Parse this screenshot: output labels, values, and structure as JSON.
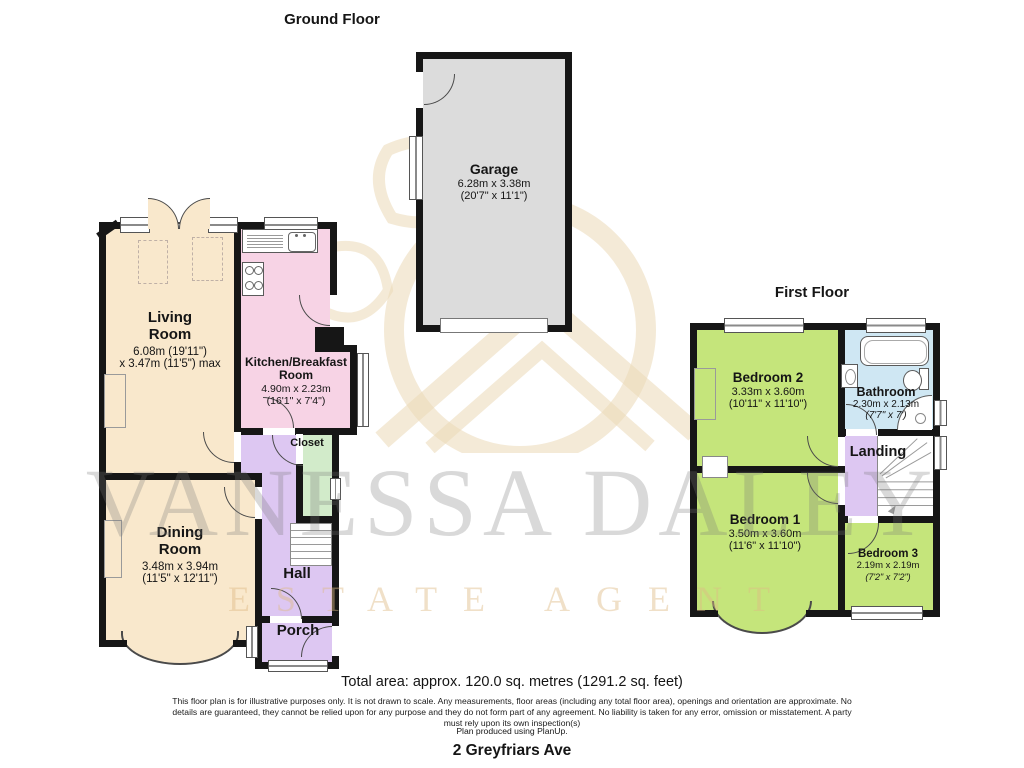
{
  "titles": {
    "ground": "Ground Floor",
    "first": "First Floor"
  },
  "rooms": {
    "garage": {
      "l1": "Garage",
      "d1": "6.28m x 3.38m",
      "d2": "(20'7\" x 11'1\")"
    },
    "living": {
      "l1": "Living",
      "l2": "Room",
      "d1": "6.08m (19'11\")",
      "d2": "x 3.47m (11'5\") max"
    },
    "kitchen": {
      "l1": "Kitchen/Breakfast",
      "l2": "Room",
      "d1": "4.90m x 2.23m",
      "d2": "(16'1\" x 7'4\")"
    },
    "dining": {
      "l1": "Dining",
      "l2": "Room",
      "d1": "3.48m x 3.94m",
      "d2": "(11'5\" x 12'11\")"
    },
    "closet": {
      "l1": "Closet"
    },
    "hall": {
      "l1": "Hall"
    },
    "porch": {
      "l1": "Porch"
    },
    "bedroom2": {
      "l1": "Bedroom 2",
      "d1": "3.33m x 3.60m",
      "d2": "(10'11\" x 11'10\")"
    },
    "bathroom": {
      "l1": "Bathroom",
      "d1": "2.30m x 2.13m",
      "d2": "(7'7\" x 7')"
    },
    "landing": {
      "l1": "Landing"
    },
    "bedroom1": {
      "l1": "Bedroom 1",
      "d1": "3.50m x 3.60m",
      "d2": "(11'6\" x 11'10\")"
    },
    "bedroom3": {
      "l1": "Bedroom 3",
      "d1": "2.19m x 2.19m",
      "d2": "(7'2\" x 7'2\")"
    }
  },
  "watermark": {
    "name": "VANESSA DALEY",
    "tagline": "ESTATE AGENT"
  },
  "footer": {
    "total_area": "Total area: approx. 120.0 sq. metres (1291.2 sq. feet)",
    "disclaimer": "This floor plan is for illustrative purposes only. It is not drawn to scale. Any measurements, floor areas (including any total floor area), openings and orientation are approximate. No details are guaranteed, they cannot be relied upon for any purpose and they do not form part of any agreement. No liability is taken for any error, omission or misstatement. A party must rely upon its own inspection(s)",
    "produced": "Plan produced using PlanUp.",
    "address": "2 Greyfriars Ave"
  },
  "colors": {
    "wall": "#161616",
    "living": "#f9e8cc",
    "kitchen": "#f7d3e5",
    "hall": "#ddc7f2",
    "closet": "#d2ebca",
    "garage": "#dcdcdc",
    "bedroom": "#c5e57b",
    "bathroom": "#cfe7f3"
  }
}
